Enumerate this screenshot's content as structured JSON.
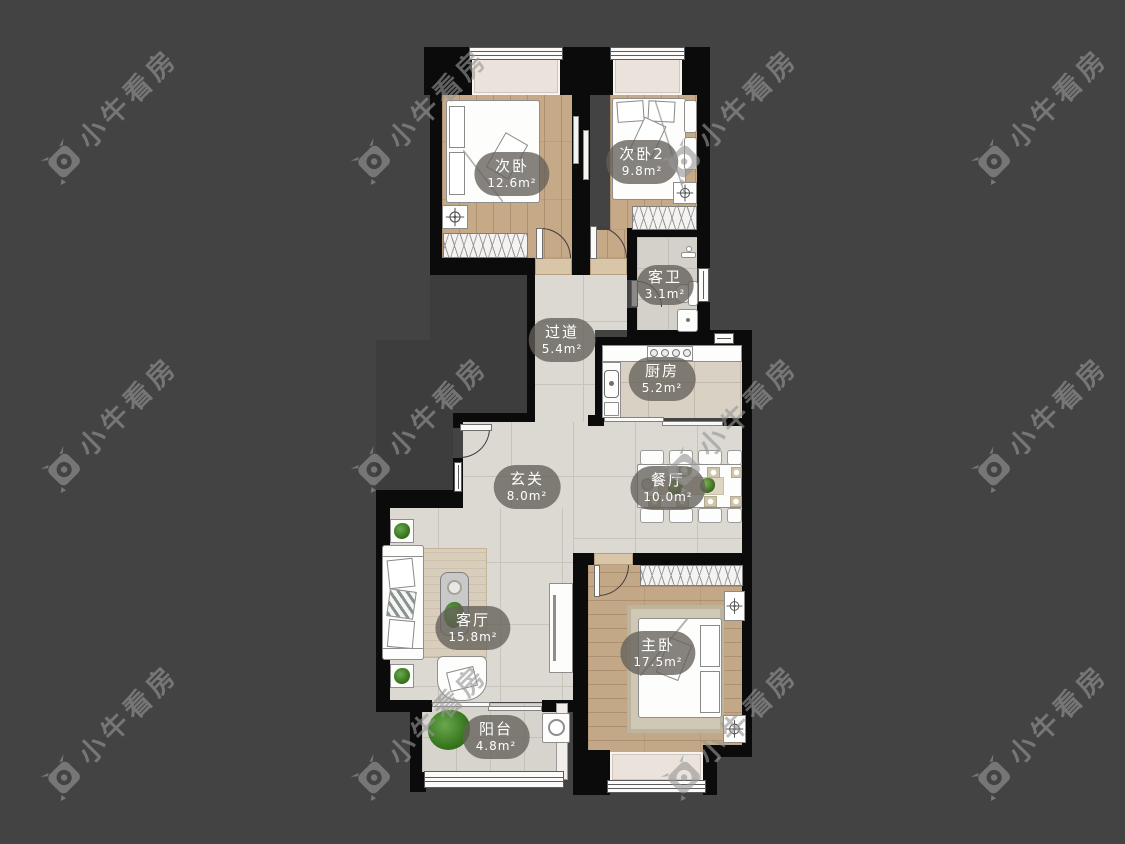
{
  "watermark": {
    "text": "小牛看房",
    "logo": "niuniu-bull-camera-logo"
  },
  "rooms": [
    {
      "name": "次卧",
      "area": "12.6m²"
    },
    {
      "name": "次卧2",
      "area": "9.8m²"
    },
    {
      "name": "客卫",
      "area": "3.1m²"
    },
    {
      "name": "过道",
      "area": "5.4m²"
    },
    {
      "name": "厨房",
      "area": "5.2m²"
    },
    {
      "name": "玄关",
      "area": "8.0m²"
    },
    {
      "name": "餐厅",
      "area": "10.0m²"
    },
    {
      "name": "客厅",
      "area": "15.8m²"
    },
    {
      "name": "主卧",
      "area": "17.5m²"
    },
    {
      "name": "阳台",
      "area": "4.8m²"
    }
  ],
  "colors": {
    "background": "#434343",
    "void": "#3d3d3d",
    "wall": "#0b0b0b",
    "wood_floor": "#c6a987",
    "tile_floor": "#dcd8d2",
    "label_pill": "rgba(100,96,90,0.78)",
    "label_text": "#ffffff",
    "watermark": "rgba(150,150,150,0.62)"
  }
}
